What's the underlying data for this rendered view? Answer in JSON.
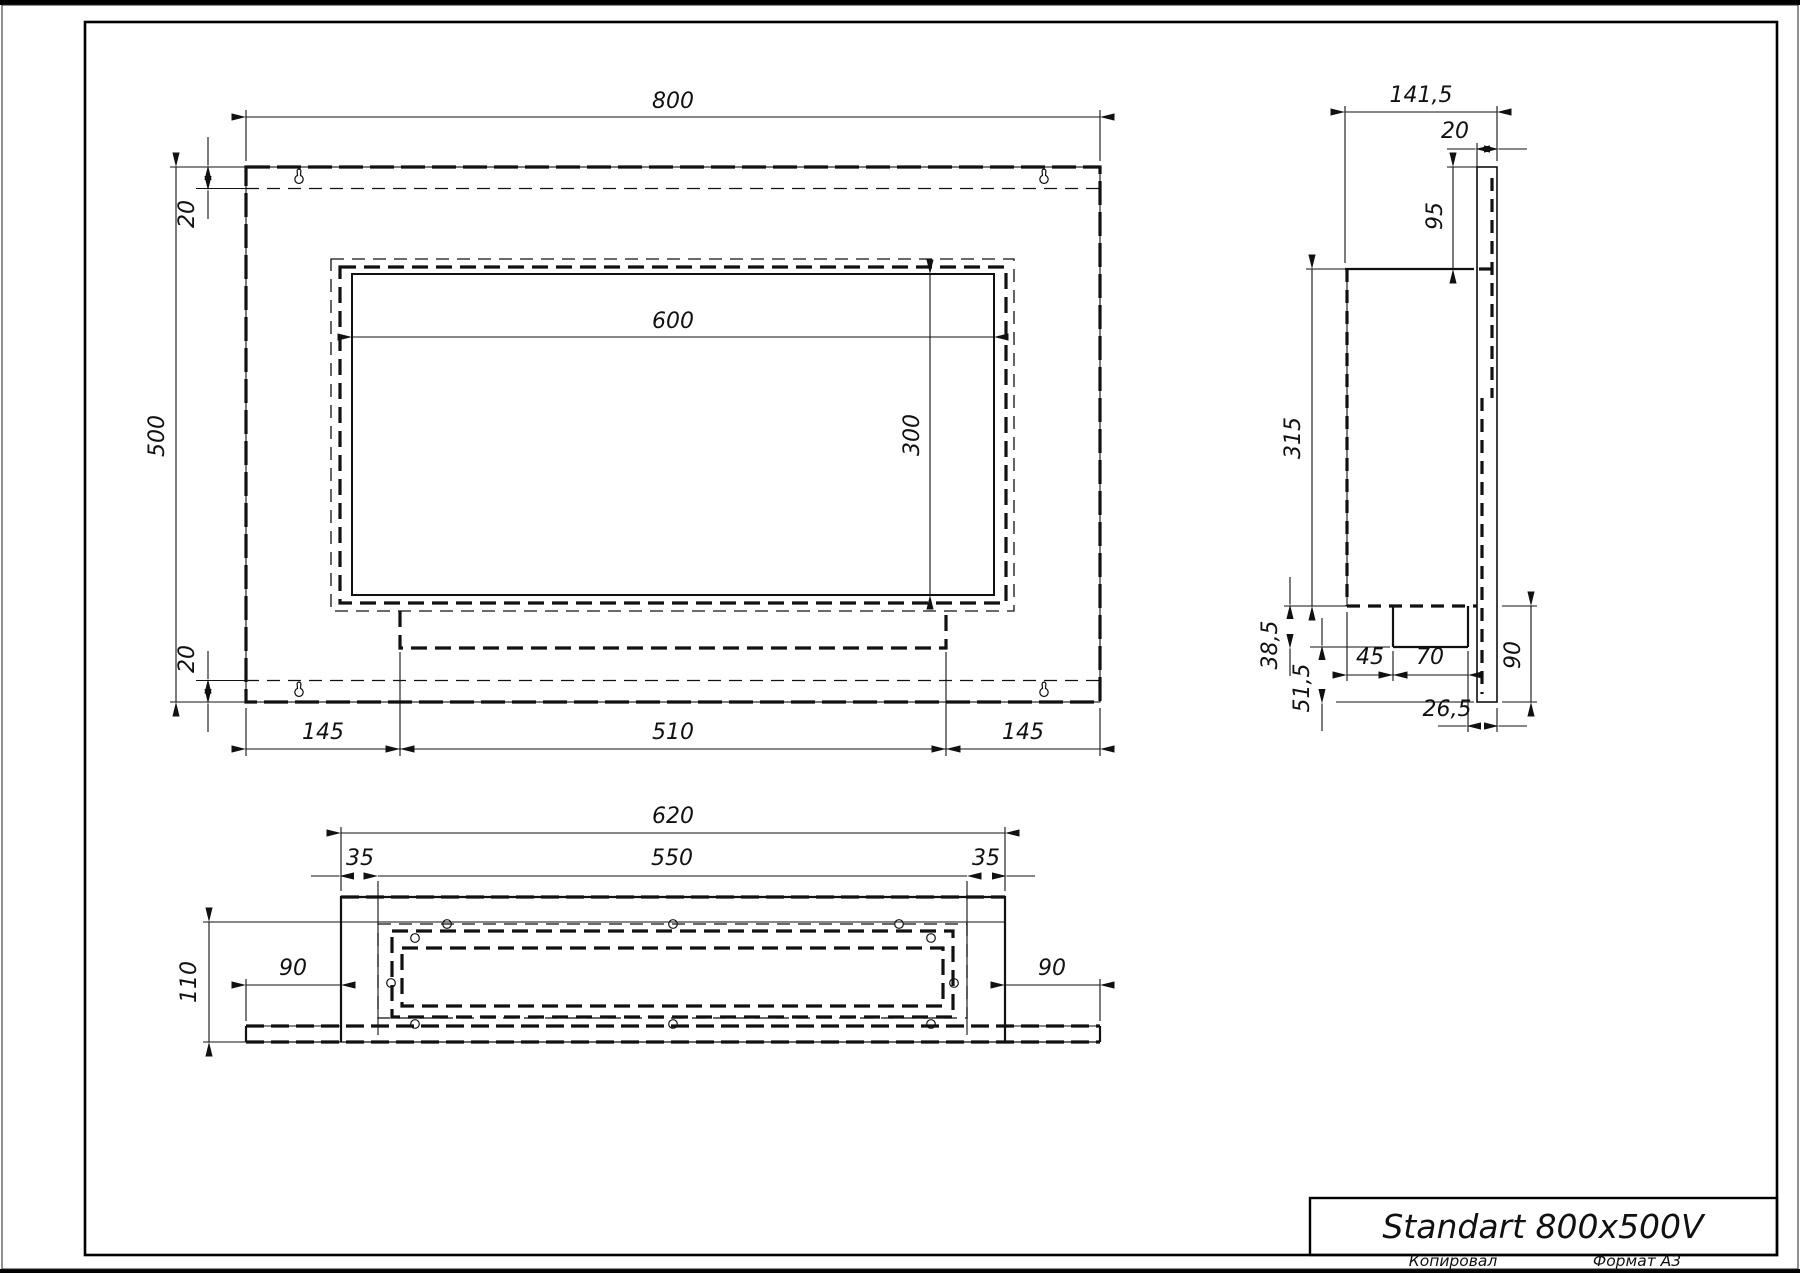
{
  "title_block": {
    "model": "Standart 800x500V"
  },
  "page": {
    "copied_label": "Копировал",
    "format_label": "Формат А3"
  },
  "colors": {
    "ink": "#111111",
    "paper": "#ffffff"
  },
  "icons": {
    "keyhole": "wall-mount keyhole slot",
    "hole": "fastener hole"
  },
  "dims": {
    "front": {
      "width": "800",
      "height": "500",
      "top_flange": "20",
      "bottom_flange": "20",
      "window_width": "600",
      "window_height": "300",
      "left_margin": "145",
      "burner_width": "510",
      "right_margin": "145"
    },
    "bottom": {
      "width": "620",
      "insert_width": "550",
      "left_margin": "35",
      "right_margin": "35",
      "depth": "110",
      "left_wing": "90",
      "right_wing": "90"
    },
    "side": {
      "total_depth": "141,5",
      "plate_thickness": "20",
      "top_offset": "95",
      "body_height": "315",
      "tray_depth": "38,5",
      "bottom_offset": "51,5",
      "tray_inset": "45",
      "tray_width": "70",
      "lip": "26,5",
      "lower_height": "90"
    }
  }
}
